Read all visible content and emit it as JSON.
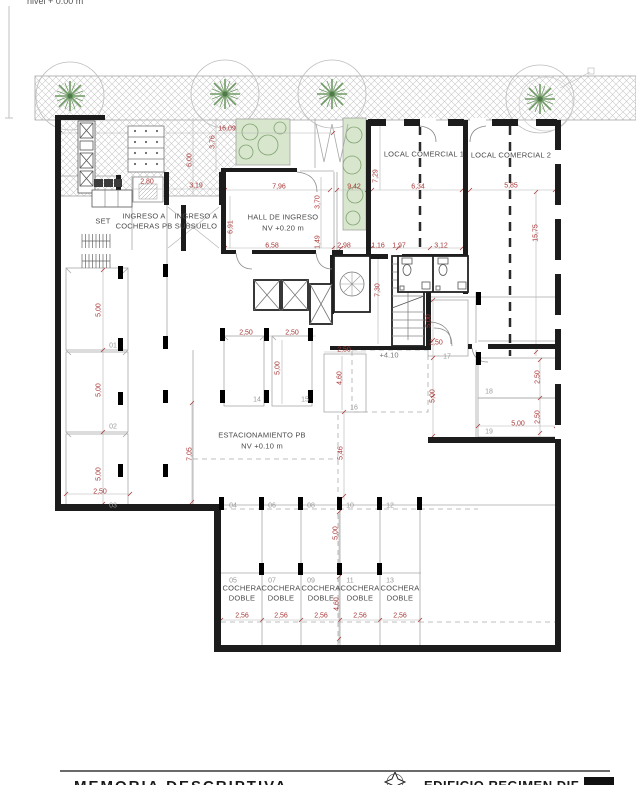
{
  "annotations": {
    "level_note": "nivel + 0.00 m",
    "mezzanine_note": "+4.10"
  },
  "colors": {
    "dimension": "#a83737",
    "wall": "#1c1c1c",
    "stall_number": "#9a9a9a",
    "vegetation_fill": "#d7e6cd",
    "vegetation_stroke": "#7fa36f",
    "hatch": "#c9c9c9"
  },
  "rooms": [
    [
      "SET",
      103,
      221
    ],
    [
      "INGRESO A",
      144,
      216
    ],
    [
      "COCHERAS PB",
      144,
      226
    ],
    [
      "INGRESO A",
      196,
      216
    ],
    [
      "SUBSUELO",
      196,
      226
    ],
    [
      "HALL DE INGRESO",
      283,
      217
    ],
    [
      "NV +0.20 m",
      283,
      228
    ],
    [
      "LOCAL COMERCIAL 1",
      424,
      154
    ],
    [
      "LOCAL COMERCIAL 2",
      511,
      155
    ],
    [
      "ESTACIONAMIENTO PB",
      262,
      435
    ],
    [
      "NV +0.10 m",
      262,
      446
    ],
    [
      "COCHERA",
      242,
      588
    ],
    [
      "DOBLE",
      242,
      598
    ],
    [
      "COCHERA",
      281,
      588
    ],
    [
      "DOBLE",
      281,
      598
    ],
    [
      "COCHERA",
      321,
      588
    ],
    [
      "DOBLE",
      321,
      598
    ],
    [
      "COCHERA",
      360,
      588
    ],
    [
      "DOBLE",
      360,
      598
    ],
    [
      "COCHERA",
      400,
      588
    ],
    [
      "DOBLE",
      400,
      598
    ]
  ],
  "dimensions": [
    [
      "16,09",
      227,
      129,
      0
    ],
    [
      "3,76",
      213,
      142,
      1
    ],
    [
      "6,00",
      190,
      160,
      1
    ],
    [
      "2,80",
      147,
      182,
      0
    ],
    [
      "3,19",
      196,
      186,
      0
    ],
    [
      "7,96",
      279,
      187,
      0
    ],
    [
      "9,42",
      354,
      187,
      0
    ],
    [
      "7,29",
      376,
      176,
      1
    ],
    [
      "6,34",
      418,
      187,
      0
    ],
    [
      "5,85",
      511,
      186,
      0
    ],
    [
      "15,75",
      536,
      233,
      1
    ],
    [
      "3,70",
      318,
      202,
      1
    ],
    [
      "6,91",
      231,
      227,
      1
    ],
    [
      "6,58",
      272,
      246,
      0
    ],
    [
      "1,49",
      318,
      242,
      1
    ],
    [
      "2,98",
      344,
      246,
      0
    ],
    [
      "1,16",
      378,
      246,
      0
    ],
    [
      "1,97",
      399,
      246,
      0
    ],
    [
      "3,12",
      441,
      246,
      0
    ],
    [
      "7,30",
      378,
      290,
      1
    ],
    [
      "5,00",
      99,
      310,
      1
    ],
    [
      "5,00",
      99,
      390,
      1
    ],
    [
      "5,00",
      99,
      474,
      1
    ],
    [
      "2,50",
      100,
      492,
      0
    ],
    [
      "2,50",
      246,
      333,
      0
    ],
    [
      "2,50",
      292,
      333,
      0
    ],
    [
      "5,00",
      278,
      368,
      1
    ],
    [
      "2,50",
      344,
      350,
      0
    ],
    [
      "4,60",
      340,
      378,
      1
    ],
    [
      "2,50",
      436,
      343,
      0
    ],
    [
      "5,00",
      429,
      321,
      1
    ],
    [
      "5,00",
      433,
      396,
      1
    ],
    [
      "2,50",
      538,
      377,
      1
    ],
    [
      "2,50",
      538,
      417,
      1
    ],
    [
      "5,00",
      518,
      424,
      0
    ],
    [
      "7,05",
      190,
      454,
      1
    ],
    [
      "5,46",
      341,
      453,
      1
    ],
    [
      "5,00",
      336,
      533,
      1
    ],
    [
      "4,60",
      337,
      604,
      1
    ],
    [
      "2,56",
      242,
      616,
      0
    ],
    [
      "2,56",
      281,
      616,
      0
    ],
    [
      "2,56",
      321,
      616,
      0
    ],
    [
      "2,56",
      360,
      616,
      0
    ],
    [
      "2,56",
      400,
      616,
      0
    ]
  ],
  "stall_numbers": [
    [
      "01",
      113,
      346
    ],
    [
      "02",
      113,
      427
    ],
    [
      "03",
      113,
      506
    ],
    [
      "04",
      233,
      506
    ],
    [
      "06",
      272,
      506
    ],
    [
      "08",
      311,
      506
    ],
    [
      "10",
      350,
      506
    ],
    [
      "12",
      390,
      506
    ],
    [
      "05",
      233,
      581
    ],
    [
      "07",
      272,
      581
    ],
    [
      "09",
      311,
      581
    ],
    [
      "11",
      350,
      581
    ],
    [
      "13",
      390,
      581
    ],
    [
      "14",
      257,
      400
    ],
    [
      "15",
      305,
      400
    ],
    [
      "16",
      354,
      408
    ],
    [
      "17",
      447,
      357
    ],
    [
      "18",
      489,
      392
    ],
    [
      "19",
      489,
      432
    ]
  ],
  "footer": {
    "left_title": "MEMORIA DESCRIPTIVA",
    "right_title": "EDIFICIO REGIMEN DIF"
  }
}
